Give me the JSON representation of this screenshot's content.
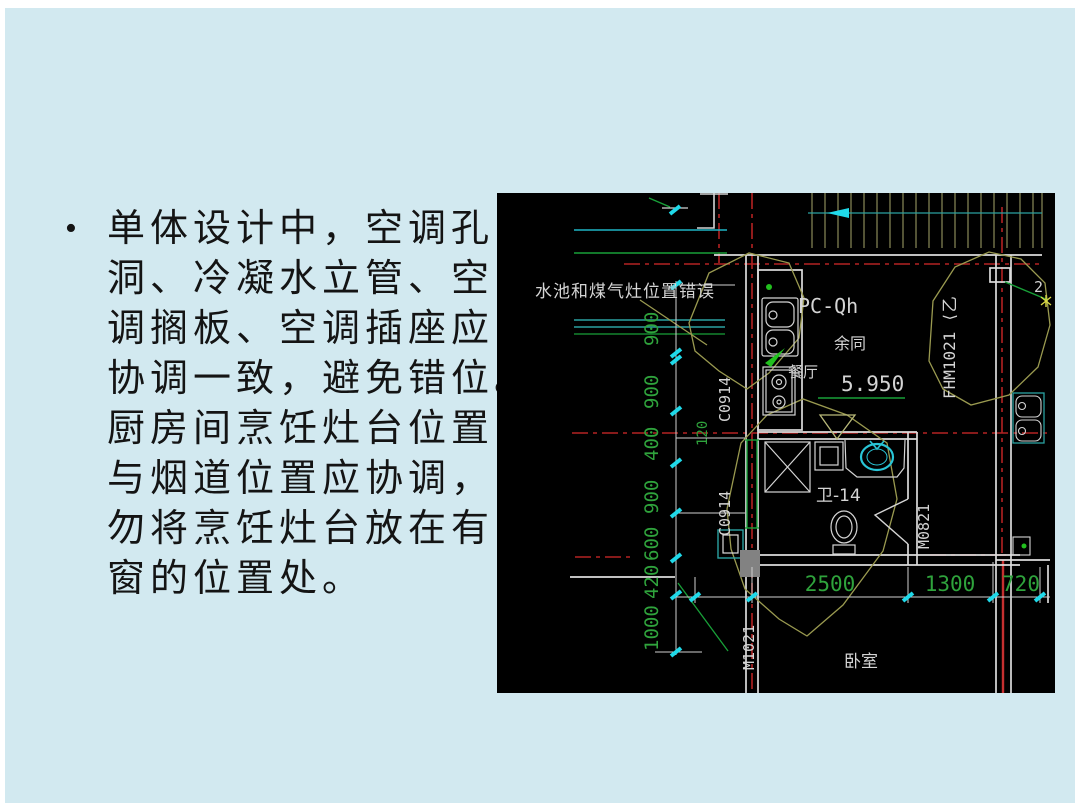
{
  "slide": {
    "background_color": "#d2e9f0",
    "bullet_char": "•",
    "lines": [
      "单体设计中，空调孔",
      "洞、冷凝水立管、空",
      "调搁板、空调插座应",
      "协调一致，避免错位。",
      "厨房间烹饪灶台位置",
      "与烟道位置应协调，",
      "勿将烹饪灶台放在有",
      "窗的位置处。"
    ]
  },
  "cad": {
    "annotation": "水池和煤气灶位置错误",
    "room_labels": {
      "dining": "餐厅",
      "same_as": "余同",
      "bath": "卫-14",
      "bedroom": "卧室"
    },
    "tags": {
      "pc": "PC-Qh",
      "level": "5.950",
      "fhm": "FHM1021 ⟨乙",
      "window": "C0914",
      "door_bath": "M0821",
      "door_bedroom": "M1021",
      "grid_two": "2"
    },
    "vdims": [
      "900",
      "900",
      "400",
      "900",
      "600",
      "420",
      "1000"
    ],
    "offset_dim": "120",
    "hdims": [
      "2500",
      "1300",
      "720"
    ],
    "colors": {
      "line_white": "#d4d4d4",
      "dim_green": "#2fa33c",
      "axis_red": "#b42222",
      "tick_cyan": "#1fd9e9",
      "cloud_olive": "#9a9a50",
      "teal": "#2aa1a1",
      "bright_green": "#22c01e",
      "fixture_cyan": "#29c5d6",
      "stairs_olive": "#a6a66a",
      "gray_block": "#828282",
      "star_yellow": "#d8d845"
    }
  }
}
